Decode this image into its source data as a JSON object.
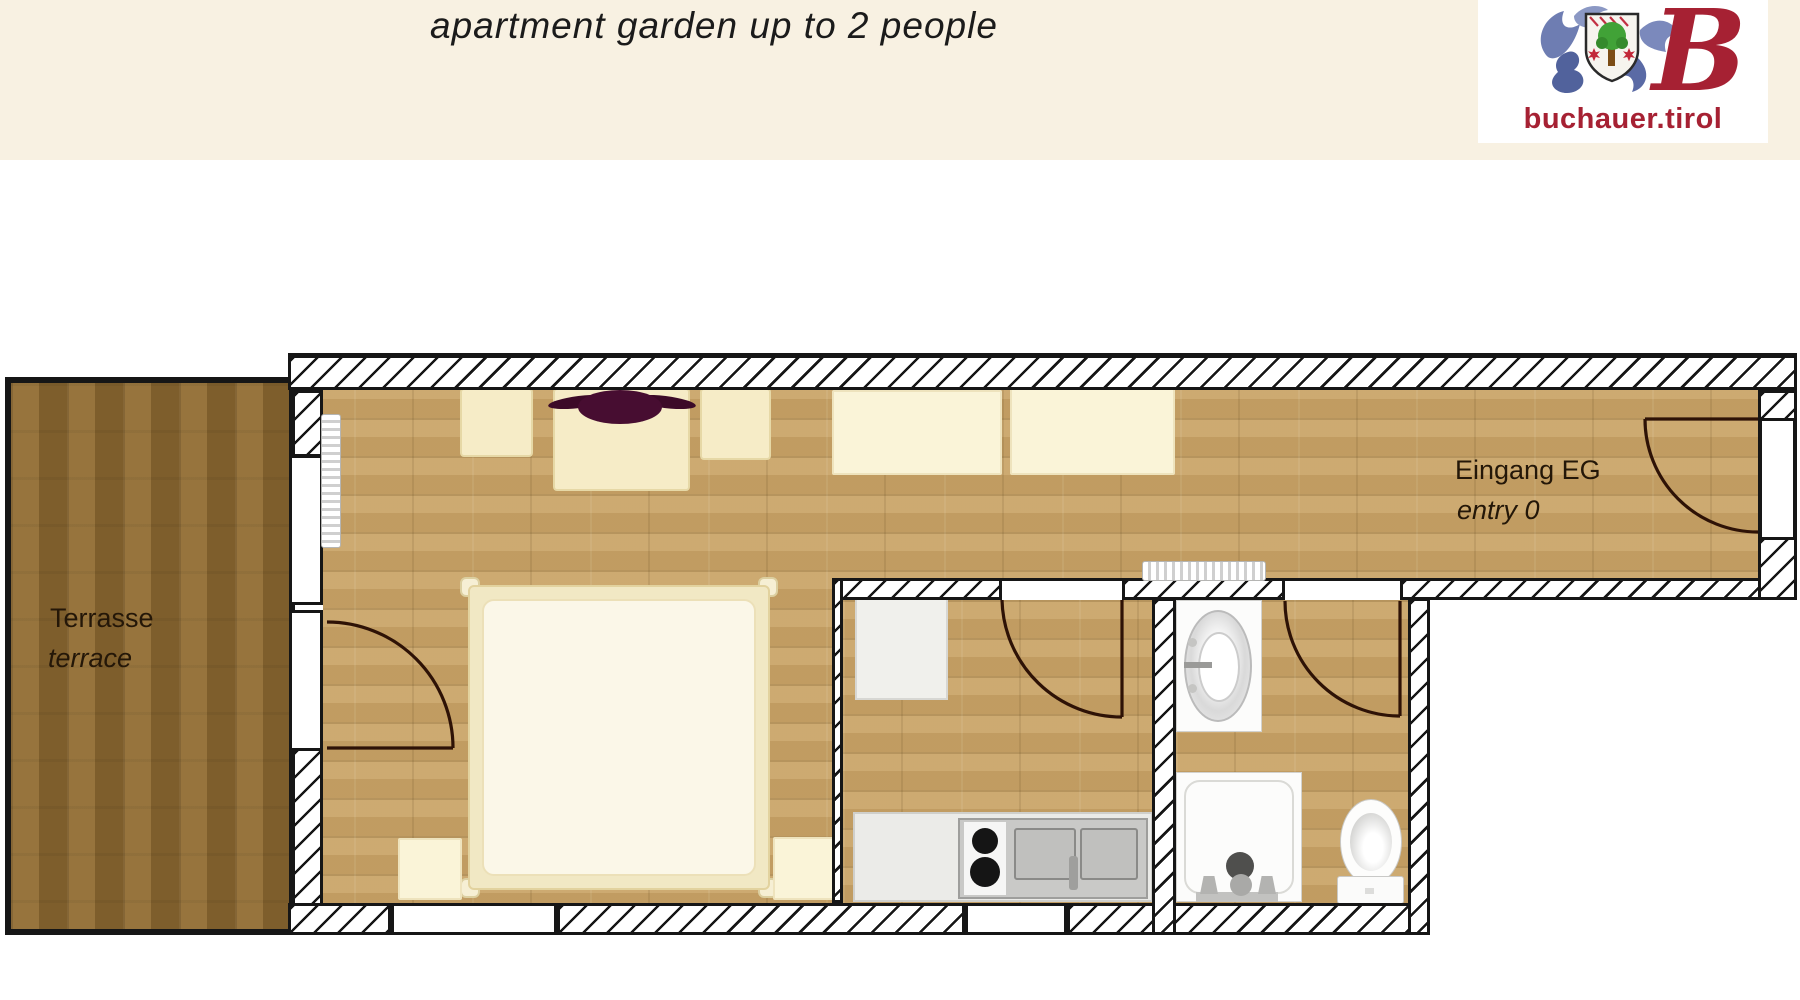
{
  "banner": {
    "title": "apartment garden up to 2 people",
    "background_color": "#f8f1e2"
  },
  "logo": {
    "site": "buchauer.tirol",
    "monogram": "B",
    "brand_color": "#a62133"
  },
  "floorplan": {
    "terrace": {
      "label_de": "Terrasse",
      "label_en": "terrace"
    },
    "entry": {
      "label_de": "Eingang EG",
      "label_en": "entry 0"
    },
    "colors": {
      "floor_wood": "#c7a368",
      "terrace_wood": "#8b6833",
      "wall_ink": "#161616",
      "door_arc": "#2e1206",
      "furniture_cream": "#f6ecc7",
      "cabinet_cream": "#faf4d8",
      "fixture_white": "#fcfcfb",
      "counter_gray": "#ebebe8",
      "plant_accent": "#470d31"
    }
  }
}
